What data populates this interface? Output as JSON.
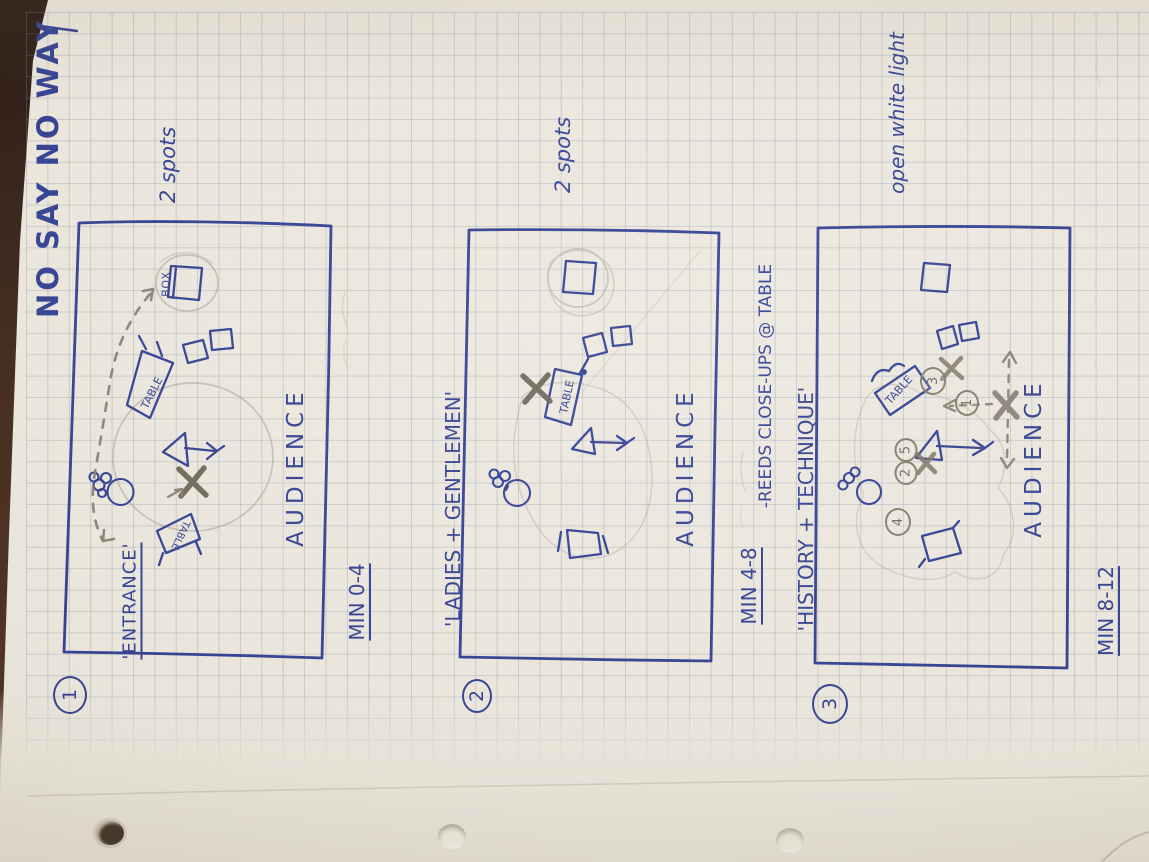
{
  "title": "NO SAY NO WAY",
  "d1": {
    "number": "1",
    "entrance": "'ENTRANCE'",
    "spots": "2 spots",
    "audience": "AUDIENCE",
    "time": "MIN 0-4",
    "box": "BOX",
    "table_upper": "TABLE",
    "table_lower": "TABLE"
  },
  "d2": {
    "number": "2",
    "scene": "'LADIES + GENTLEMEN'",
    "spots": "2 spots",
    "audience": "AUDIENCE",
    "time": "MIN 4-8",
    "note": "-REEDS CLOSE-UPS @ TABLE",
    "table": "TABLE"
  },
  "d3": {
    "number": "3",
    "scene": "'HISTORY + TECHNIQUE'",
    "lighting": "open white light",
    "audience": "AUDIENCE",
    "time": "MIN 8-12",
    "table": "TABLE",
    "pos1": "1",
    "pos2": "2",
    "pos3": "3",
    "pos4": "4",
    "pos5": "5"
  }
}
